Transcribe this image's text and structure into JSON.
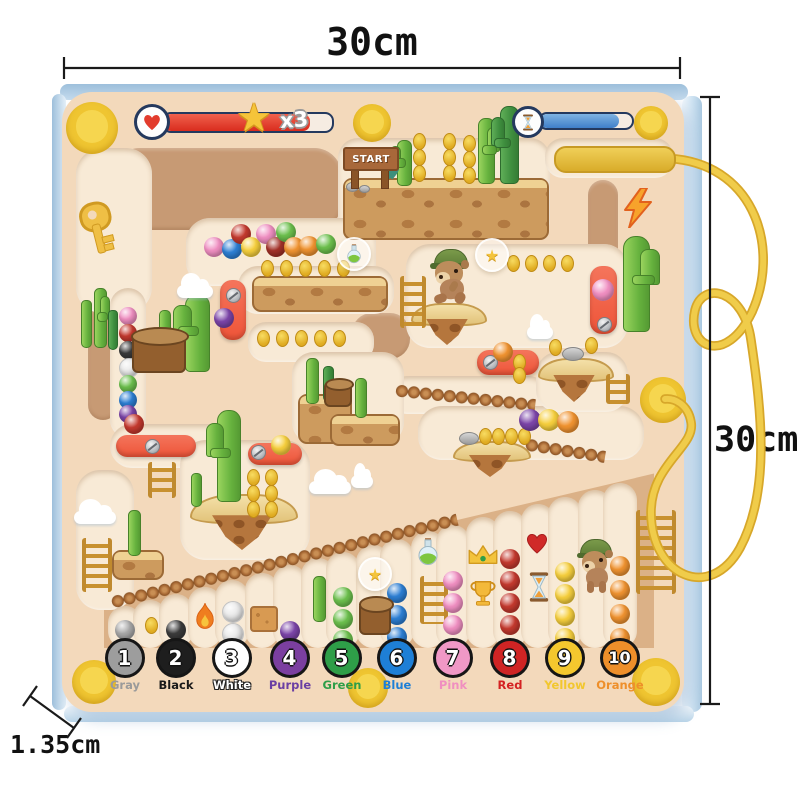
{
  "dimensions": {
    "top_label": "30cm",
    "right_label": "30cm",
    "thickness_label": "1.35cm"
  },
  "hud": {
    "star_multiplier": "x3",
    "start_sign": "START"
  },
  "icons": {
    "star": "★"
  },
  "palette": {
    "board": "#f3d9bb",
    "path": "#f8ead6",
    "wall": "#c79a74",
    "zone": "#dbb187",
    "red_piece": "#ee5438",
    "pen": "#e8c33f",
    "cord": "#ecc53e",
    "magnet": "#efc531",
    "health": "#e23b2c",
    "timer": "#4f93d9",
    "pink": "#f08fc2",
    "blue": "#2d7fd4",
    "red": "#c4392e",
    "darkred": "#a23028",
    "yellow": "#f6cf3d",
    "orange": "#f09330",
    "green": "#6cc04d",
    "purple": "#7b44a8",
    "gray": "#a8a8a8",
    "black": "#3b3b3b",
    "white": "#e9e9e9"
  },
  "legend": [
    {
      "n": "1",
      "label": "Gray",
      "fill": "#9d9d9d",
      "lc": "#9a9a9a",
      "out": false
    },
    {
      "n": "2",
      "label": "Black",
      "fill": "#1e1e1e",
      "lc": "#1a1a1a",
      "out": false
    },
    {
      "n": "3",
      "label": "White",
      "fill": "#ffffff",
      "lc": "#ffffff",
      "out": true
    },
    {
      "n": "4",
      "label": "Purple",
      "fill": "#7b3fa0",
      "lc": "#6b3fa3",
      "out": false
    },
    {
      "n": "5",
      "label": "Green",
      "fill": "#2e9e48",
      "lc": "#2e9e48",
      "out": false
    },
    {
      "n": "6",
      "label": "Blue",
      "fill": "#1e7fd6",
      "lc": "#1e7fd6",
      "out": false
    },
    {
      "n": "7",
      "label": "Pink",
      "fill": "#f098c6",
      "lc": "#f08fc0",
      "out": false
    },
    {
      "n": "8",
      "label": "Red",
      "fill": "#cf2424",
      "lc": "#d42222",
      "out": false
    },
    {
      "n": "9",
      "label": "Yellow",
      "fill": "#f4c72e",
      "lc": "#f2c72e",
      "out": false
    },
    {
      "n": "10",
      "label": "Orange",
      "fill": "#ee8f2a",
      "lc": "#ee8f2a",
      "out": false
    }
  ],
  "legend_x": [
    125,
    176,
    232,
    290,
    342,
    397,
    453,
    510,
    565,
    620
  ],
  "scene": {
    "walls": [
      [
        227,
        189,
        230,
        82,
        28
      ],
      [
        103,
        362,
        30,
        115,
        15
      ],
      [
        381,
        336,
        58,
        46,
        20
      ],
      [
        603,
        227,
        30,
        94,
        15
      ]
    ],
    "paths": [
      [
        114,
        230,
        76,
        165,
        26
      ],
      [
        128,
        363,
        36,
        150,
        18
      ],
      [
        175,
        446,
        130,
        44,
        22
      ],
      [
        444,
        189,
        212,
        102,
        20
      ],
      [
        609,
        158,
        128,
        40,
        18
      ],
      [
        281,
        252,
        190,
        68,
        24
      ],
      [
        316,
        290,
        156,
        48,
        20
      ],
      [
        311,
        342,
        126,
        40,
        18
      ],
      [
        517,
        296,
        222,
        104,
        24
      ],
      [
        468,
        395,
        160,
        38,
        19
      ],
      [
        531,
        433,
        226,
        54,
        24
      ],
      [
        348,
        398,
        112,
        92,
        22
      ],
      [
        582,
        382,
        92,
        60,
        22
      ],
      [
        105,
        540,
        58,
        140,
        24
      ],
      [
        245,
        500,
        130,
        120,
        26
      ]
    ],
    "slots": [
      [
        125,
        606
      ],
      [
        150,
        600
      ],
      [
        176,
        594
      ],
      [
        205,
        587
      ],
      [
        232,
        580
      ],
      [
        262,
        573
      ],
      [
        290,
        565
      ],
      [
        318,
        558
      ],
      [
        343,
        552
      ],
      [
        373,
        545
      ],
      [
        397,
        539
      ],
      [
        428,
        531
      ],
      [
        453,
        525
      ],
      [
        483,
        517
      ],
      [
        510,
        511
      ],
      [
        538,
        504
      ],
      [
        565,
        497
      ],
      [
        595,
        490
      ],
      [
        620,
        483
      ]
    ],
    "slot_width": 34,
    "slot_bottom": 648,
    "balls": [
      [
        "pink",
        214,
        247,
        10
      ],
      [
        "blue",
        232,
        249,
        10
      ],
      [
        "red",
        241,
        234,
        10
      ],
      [
        "yellow",
        251,
        247,
        10
      ],
      [
        "pink",
        266,
        234,
        10
      ],
      [
        "darkred",
        276,
        247,
        10
      ],
      [
        "green",
        286,
        232,
        10
      ],
      [
        "orange",
        294,
        247,
        10
      ],
      [
        "orange",
        309,
        246,
        10
      ],
      [
        "green",
        326,
        244,
        10
      ],
      [
        "pink",
        128,
        316,
        9
      ],
      [
        "red",
        128,
        333,
        9
      ],
      [
        "black",
        128,
        350,
        9
      ],
      [
        "white",
        128,
        367,
        9
      ],
      [
        "green",
        128,
        384,
        9
      ],
      [
        "blue",
        128,
        400,
        9
      ],
      [
        "purple",
        128,
        414,
        9
      ],
      [
        "purple",
        224,
        318,
        10
      ],
      [
        "pink",
        603,
        290,
        11
      ],
      [
        "orange",
        503,
        352,
        10
      ],
      [
        "yellow",
        281,
        445,
        10
      ],
      [
        "red",
        134,
        424,
        10
      ],
      [
        "purple",
        530,
        420,
        11
      ],
      [
        "yellow",
        549,
        420,
        11
      ],
      [
        "orange",
        568,
        422,
        11
      ],
      [
        "gray",
        125,
        630,
        10
      ],
      [
        "black",
        176,
        630,
        10
      ],
      [
        "white",
        232,
        611,
        10
      ],
      [
        "white",
        232,
        633,
        10
      ],
      [
        "purple",
        290,
        631,
        10
      ],
      [
        "green",
        343,
        597,
        10
      ],
      [
        "green",
        343,
        619,
        10
      ],
      [
        "green",
        343,
        640,
        10
      ],
      [
        "blue",
        397,
        593,
        10
      ],
      [
        "blue",
        397,
        615,
        10
      ],
      [
        "blue",
        397,
        637,
        10
      ],
      [
        "pink",
        453,
        581,
        10
      ],
      [
        "pink",
        453,
        603,
        10
      ],
      [
        "pink",
        453,
        625,
        10
      ],
      [
        "red",
        510,
        559,
        10
      ],
      [
        "red",
        510,
        581,
        10
      ],
      [
        "red",
        510,
        603,
        10
      ],
      [
        "red",
        510,
        625,
        10
      ],
      [
        "yellow",
        565,
        572,
        10
      ],
      [
        "yellow",
        565,
        594,
        10
      ],
      [
        "yellow",
        565,
        616,
        10
      ],
      [
        "yellow",
        565,
        638,
        10
      ],
      [
        "orange",
        620,
        566,
        10
      ],
      [
        "orange",
        620,
        590,
        10
      ],
      [
        "orange",
        620,
        614,
        10
      ],
      [
        "orange",
        620,
        638,
        10
      ]
    ],
    "coins": [
      [
        418,
        140
      ],
      [
        418,
        156
      ],
      [
        418,
        172
      ],
      [
        448,
        140
      ],
      [
        448,
        156
      ],
      [
        448,
        172
      ],
      [
        468,
        142
      ],
      [
        468,
        158
      ],
      [
        468,
        174
      ],
      [
        266,
        267
      ],
      [
        285,
        267
      ],
      [
        304,
        267
      ],
      [
        323,
        267
      ],
      [
        342,
        267
      ],
      [
        512,
        262
      ],
      [
        530,
        262
      ],
      [
        548,
        262
      ],
      [
        566,
        262
      ],
      [
        262,
        337
      ],
      [
        281,
        337
      ],
      [
        300,
        337
      ],
      [
        319,
        337
      ],
      [
        338,
        337
      ],
      [
        554,
        346
      ],
      [
        590,
        344
      ],
      [
        518,
        361
      ],
      [
        518,
        374
      ],
      [
        484,
        435
      ],
      [
        497,
        435
      ],
      [
        510,
        435
      ],
      [
        523,
        435
      ],
      [
        252,
        476
      ],
      [
        270,
        476
      ],
      [
        252,
        492
      ],
      [
        270,
        492
      ],
      [
        252,
        508
      ],
      [
        270,
        508
      ],
      [
        150,
        624
      ]
    ],
    "ladders": [
      [
        409,
        302,
        18,
        52
      ],
      [
        430,
        600,
        20,
        48
      ],
      [
        614,
        389,
        16,
        30
      ],
      [
        158,
        480,
        20,
        36
      ],
      [
        93,
        565,
        22,
        54
      ],
      [
        652,
        552,
        32,
        84
      ]
    ],
    "bridges": [
      [
        396,
        390,
        140,
        6
      ],
      [
        526,
        444,
        80,
        9
      ],
      [
        112,
        602,
        355,
        -13.5
      ]
    ],
    "islands": [
      [
        447,
        324,
        72,
        42,
        0
      ],
      [
        574,
        380,
        72,
        44,
        1
      ],
      [
        490,
        459,
        74,
        36,
        1
      ],
      [
        242,
        522,
        104,
        56,
        0
      ]
    ],
    "platforms": [
      [
        444,
        207,
        202,
        58
      ],
      [
        318,
        292,
        132,
        32
      ],
      [
        323,
        417,
        50,
        46
      ],
      [
        363,
        428,
        66,
        28
      ],
      [
        136,
        563,
        48,
        26
      ]
    ],
    "red_pieces": [
      [
        233,
        310,
        26,
        60
      ],
      [
        603,
        300,
        27,
        68
      ],
      [
        508,
        362,
        62,
        25
      ],
      [
        156,
        446,
        80,
        22
      ],
      [
        275,
        454,
        54,
        22
      ]
    ],
    "screws": [
      [
        233,
        295
      ],
      [
        604,
        324
      ],
      [
        490,
        362
      ],
      [
        152,
        446
      ],
      [
        258,
        452
      ],
      [
        197,
        294
      ]
    ],
    "rocks": [
      [
        572,
        353,
        20,
        12
      ],
      [
        468,
        437,
        18,
        11
      ],
      [
        351,
        186,
        11,
        8
      ],
      [
        363,
        188,
        9,
        6
      ]
    ],
    "cacti": [
      [
        403,
        184,
        26,
        44,
        "L",
        0
      ],
      [
        485,
        182,
        30,
        64,
        "R",
        0
      ],
      [
        508,
        182,
        34,
        76,
        "L",
        1
      ],
      [
        635,
        330,
        50,
        94,
        "R",
        0
      ],
      [
        85,
        346,
        18,
        46,
        null,
        0
      ],
      [
        99,
        346,
        22,
        58,
        "R",
        0
      ],
      [
        112,
        348,
        16,
        38,
        null,
        1
      ],
      [
        196,
        370,
        46,
        76,
        "L",
        0
      ],
      [
        164,
        340,
        20,
        30,
        null,
        0
      ],
      [
        228,
        500,
        44,
        90,
        "L",
        0
      ],
      [
        195,
        505,
        18,
        32,
        null,
        0
      ],
      [
        133,
        554,
        22,
        44,
        null,
        0
      ],
      [
        311,
        402,
        22,
        44,
        null,
        0
      ],
      [
        327,
        400,
        18,
        34,
        null,
        1
      ],
      [
        360,
        416,
        20,
        38,
        null,
        0
      ],
      [
        318,
        620,
        22,
        44,
        null,
        0
      ]
    ],
    "stumps": [
      [
        157,
        351,
        50,
        36
      ],
      [
        336,
        392,
        24,
        22
      ],
      [
        373,
        616,
        28,
        30
      ]
    ],
    "clouds": [
      [
        195,
        291,
        36
      ],
      [
        95,
        517,
        42
      ],
      [
        330,
        487,
        42
      ],
      [
        362,
        481,
        22
      ],
      [
        540,
        332,
        26
      ]
    ],
    "bears": [
      [
        451,
        277,
        46,
        56,
        "run"
      ],
      [
        596,
        566,
        42,
        54,
        "walk"
      ]
    ],
    "items": [
      [
        "key",
        96,
        228
      ],
      [
        "lightning",
        638,
        208
      ],
      [
        "agave",
        390,
        176
      ],
      [
        "fire",
        205,
        617
      ],
      [
        "sandblock",
        262,
        617
      ],
      [
        "potionbubble",
        352,
        252
      ],
      [
        "starbubble",
        490,
        253
      ],
      [
        "starbubble",
        373,
        572
      ],
      [
        "potion",
        428,
        552
      ],
      [
        "crown",
        483,
        555
      ],
      [
        "trophy",
        483,
        593
      ],
      [
        "heart",
        537,
        543
      ],
      [
        "hourglass",
        539,
        587
      ]
    ],
    "magnets": [
      [
        92,
        128,
        52
      ],
      [
        372,
        123,
        38
      ],
      [
        651,
        123,
        34
      ],
      [
        663,
        400,
        46
      ],
      [
        94,
        682,
        44
      ],
      [
        368,
        688,
        40
      ],
      [
        656,
        682,
        48
      ]
    ],
    "sign": {
      "x": 369,
      "y": 157,
      "w": 52,
      "h": 20
    }
  }
}
